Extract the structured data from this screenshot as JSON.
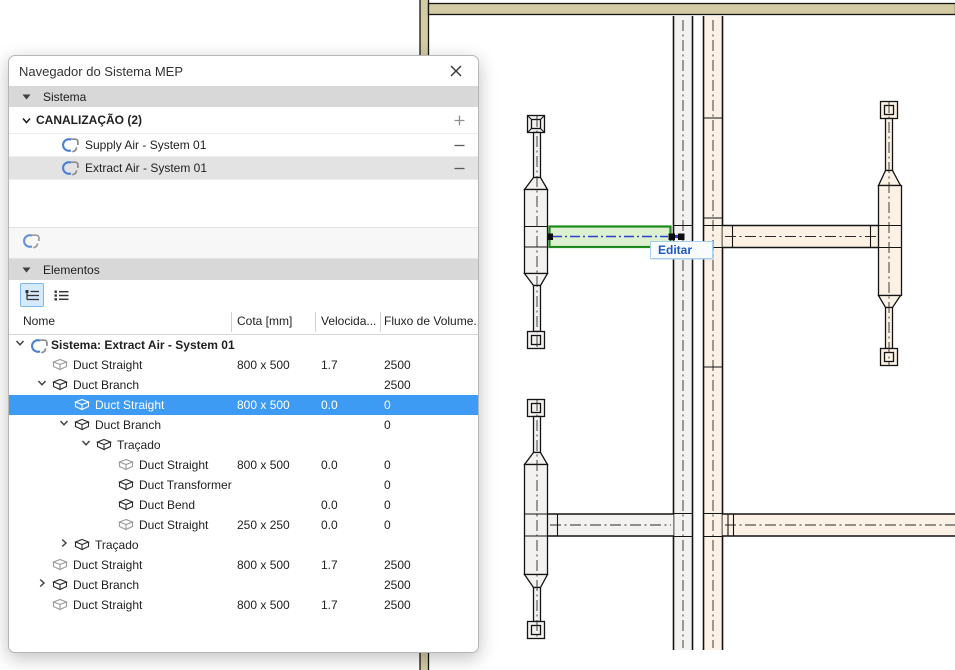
{
  "panel": {
    "title": "Navegador do Sistema MEP",
    "sections": {
      "sistema": "Sistema",
      "elementos": "Elementos"
    },
    "canalizacao": {
      "label": "CANALIZAÇÃO (2)",
      "systems": [
        {
          "name": "Supply Air - System 01",
          "selected": false
        },
        {
          "name": "Extract Air - System 01",
          "selected": true
        }
      ]
    },
    "table": {
      "columns": [
        "Nome",
        "Cota [mm]",
        "Velocida...",
        "Fluxo de Volume..."
      ],
      "rows": [
        {
          "level": 0,
          "chevron": "expanded",
          "icon": "system-icon",
          "name": "Sistema: Extract Air - System 01",
          "bold": true,
          "cota": "",
          "vel": "",
          "fluxo": "",
          "selected": false
        },
        {
          "level": 1,
          "chevron": "none",
          "icon": "duct-straight-icon",
          "name": "Duct Straight",
          "cota": "800 x 500",
          "vel": "1.7",
          "fluxo": "2500",
          "selected": false
        },
        {
          "level": 1,
          "chevron": "expanded",
          "icon": "duct-branch-icon",
          "name": "Duct Branch",
          "cota": "",
          "vel": "",
          "fluxo": "2500",
          "selected": false
        },
        {
          "level": 2,
          "chevron": "none",
          "icon": "duct-straight-icon",
          "name": "Duct Straight",
          "cota": "800 x 500",
          "vel": "0.0",
          "fluxo": "0",
          "selected": true
        },
        {
          "level": 2,
          "chevron": "expanded",
          "icon": "duct-branch-icon",
          "name": "Duct Branch",
          "cota": "",
          "vel": "",
          "fluxo": "0",
          "selected": false
        },
        {
          "level": 3,
          "chevron": "expanded",
          "icon": "duct-branch-icon",
          "name": "Traçado",
          "cota": "",
          "vel": "",
          "fluxo": "",
          "selected": false
        },
        {
          "level": 4,
          "chevron": "none",
          "icon": "duct-straight-icon",
          "name": "Duct Straight",
          "cota": "800 x 500",
          "vel": "0.0",
          "fluxo": "0",
          "selected": false
        },
        {
          "level": 4,
          "chevron": "none",
          "icon": "duct-transformer-icon",
          "name": "Duct Transformer",
          "cota": "",
          "vel": "",
          "fluxo": "0",
          "selected": false
        },
        {
          "level": 4,
          "chevron": "none",
          "icon": "duct-bend-icon",
          "name": "Duct Bend",
          "cota": "",
          "vel": "0.0",
          "fluxo": "0",
          "selected": false
        },
        {
          "level": 4,
          "chevron": "none",
          "icon": "duct-straight-icon",
          "name": "Duct Straight",
          "cota": "250 x 250",
          "vel": "0.0",
          "fluxo": "0",
          "selected": false
        },
        {
          "level": 2,
          "chevron": "collapsed",
          "icon": "duct-branch-icon",
          "name": "Traçado",
          "cota": "",
          "vel": "",
          "fluxo": "",
          "selected": false
        },
        {
          "level": 1,
          "chevron": "none",
          "icon": "duct-straight-icon",
          "name": "Duct Straight",
          "cota": "800 x 500",
          "vel": "1.7",
          "fluxo": "2500",
          "selected": false
        },
        {
          "level": 1,
          "chevron": "collapsed",
          "icon": "duct-branch-icon",
          "name": "Duct Branch",
          "cota": "",
          "vel": "",
          "fluxo": "2500",
          "selected": false
        },
        {
          "level": 1,
          "chevron": "none",
          "icon": "duct-straight-icon",
          "name": "Duct Straight",
          "cota": "800 x 500",
          "vel": "1.7",
          "fluxo": "2500",
          "selected": false
        }
      ]
    }
  },
  "canvas": {
    "tooltip_label": "Editar"
  },
  "colors": {
    "selection_blue": "#3e9bf4",
    "highlight_green_border": "#1d8a1d",
    "highlight_green_fill": "#d8eeca",
    "wall_tan": "#d2cba3",
    "duct_beige": "#fbf1e5",
    "duct_gray": "#f4f2f1",
    "centerline_blue": "#2b3fd0",
    "tooltip_text_blue": "#1e56c0"
  }
}
